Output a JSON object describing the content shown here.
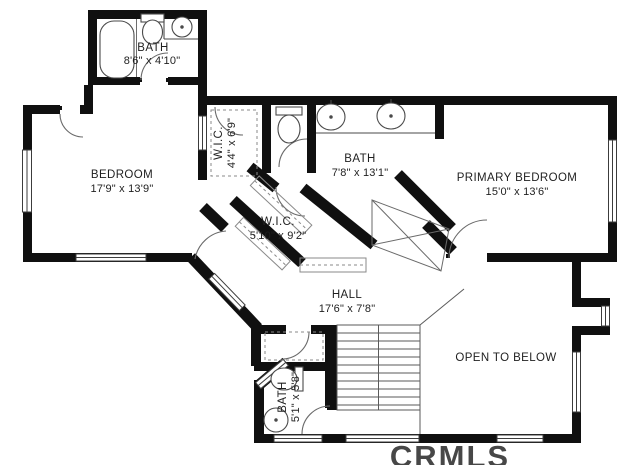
{
  "watermark": "CRMLS",
  "rooms": {
    "bath_top": {
      "label": "BATH",
      "dims": "8'6\" x 4'10\""
    },
    "bedroom": {
      "label": "BEDROOM",
      "dims": "17'9\" x 13'9\""
    },
    "wic_small": {
      "label": "W.I.C.",
      "dims": "4'4\" x 6'9\""
    },
    "bath_mid": {
      "label": "BATH",
      "dims": "7'8\" x 13'1\""
    },
    "primary_bedroom": {
      "label": "PRIMARY BEDROOM",
      "dims": "15'0\" x 13'6\""
    },
    "wic_large": {
      "label": "W.I.C.",
      "dims": "5'10\" x 9'2\""
    },
    "hall": {
      "label": "HALL",
      "dims": "17'6\" x 7'8\""
    },
    "bath_bottom": {
      "label": "BATH",
      "dims": "5'1\" x 5'8\""
    },
    "open_to_below": {
      "label": "OPEN TO BELOW"
    }
  }
}
